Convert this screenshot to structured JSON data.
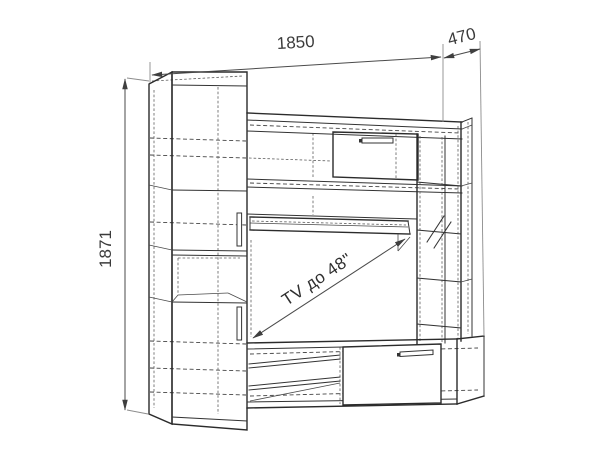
{
  "drawing": {
    "dimensions": {
      "width": "1850",
      "depth": "470",
      "height": "1871"
    },
    "annotation": {
      "tv_note": "TV до 48\""
    },
    "colors": {
      "line": "#2b2b2b",
      "dimension": "#4a4a4a",
      "background": "#ffffff"
    }
  }
}
